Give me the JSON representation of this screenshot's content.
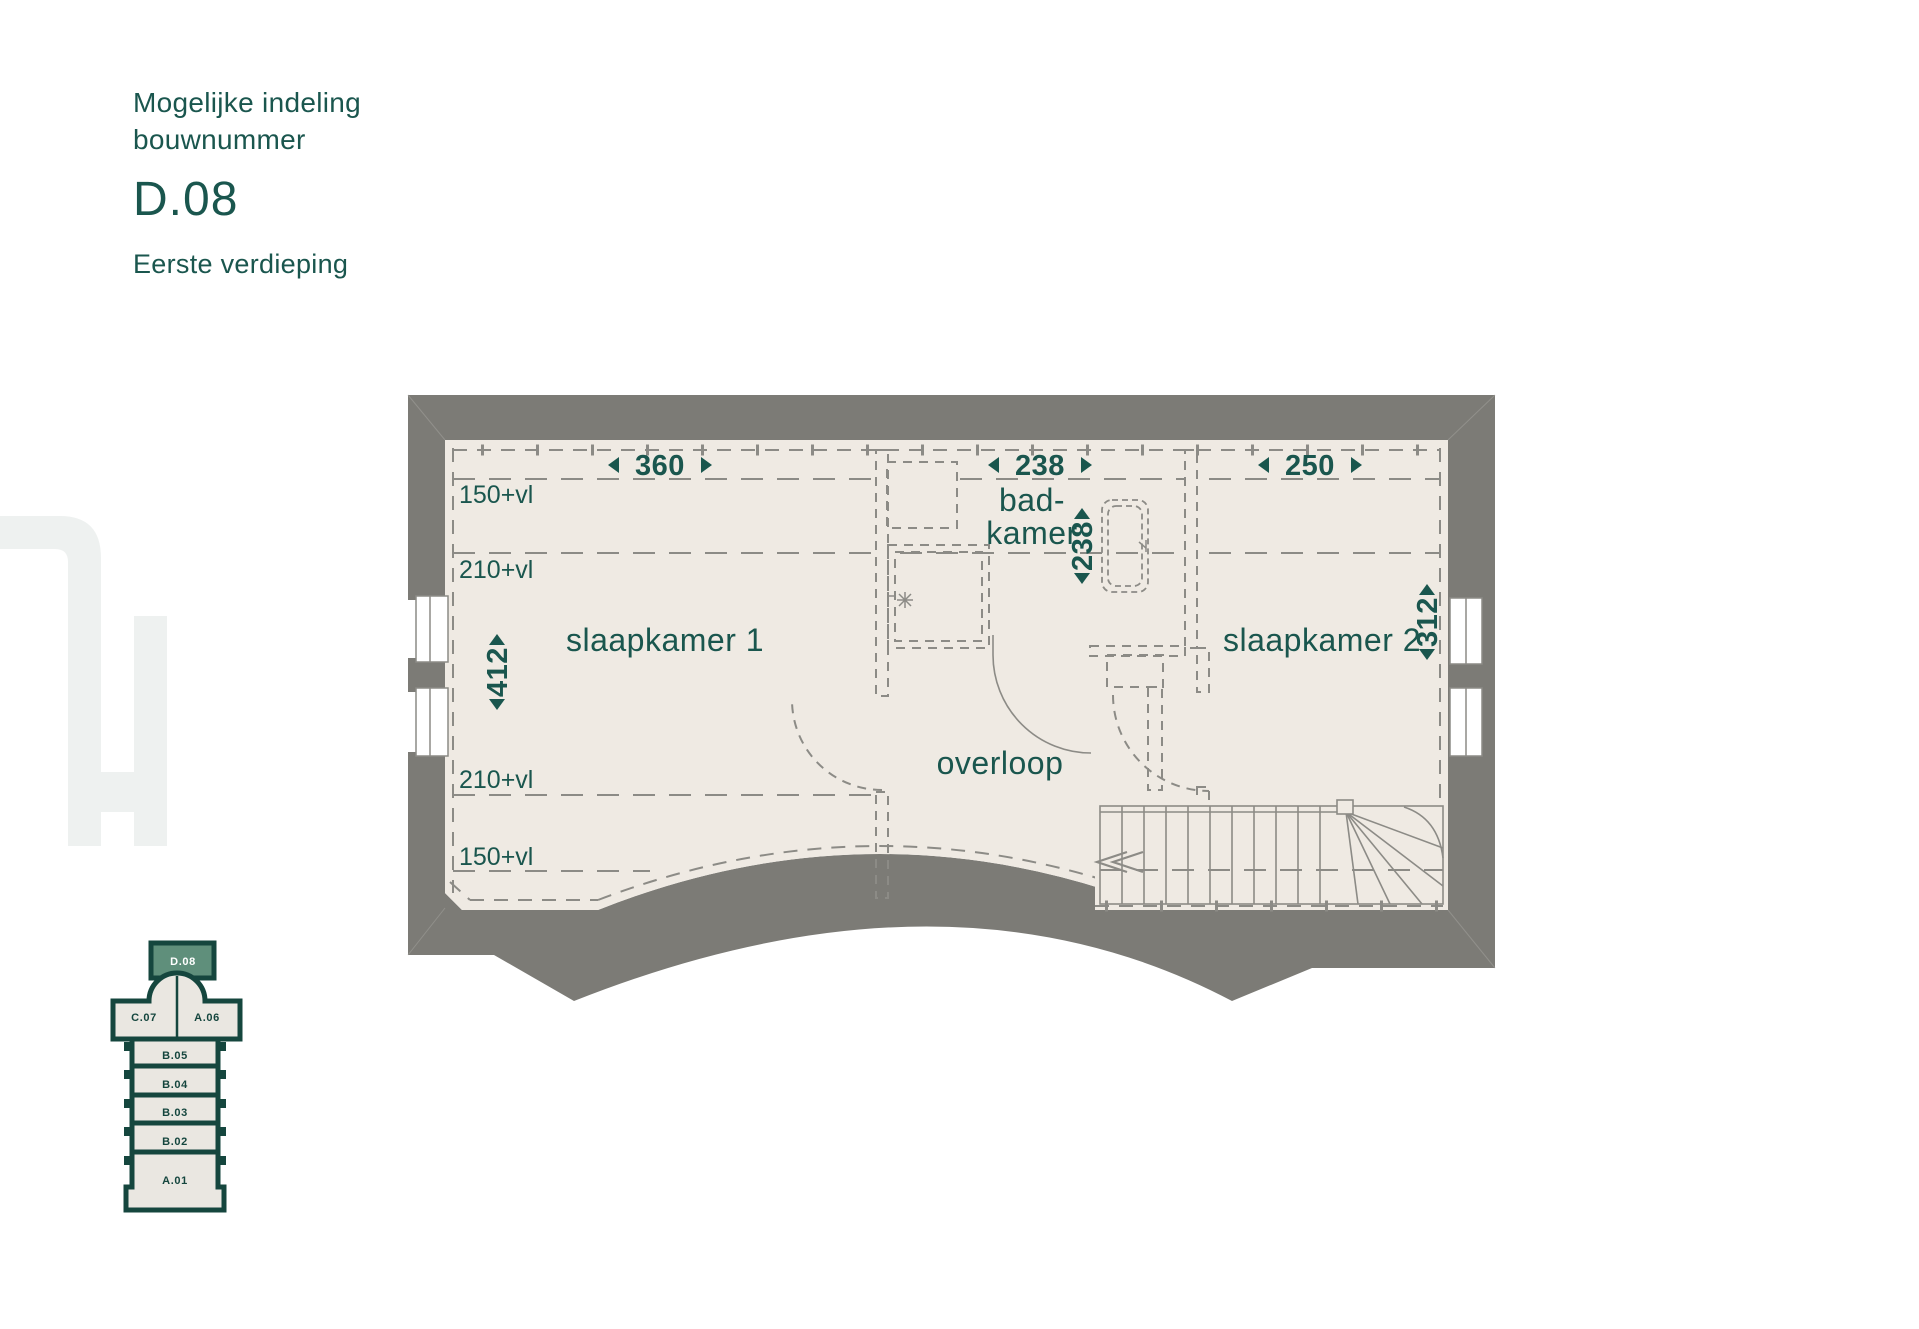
{
  "header": {
    "line1": "Mogelijke indeling",
    "line2": "bouwnummer",
    "unit": "D.08",
    "floor": "Eerste verdieping"
  },
  "floorplan": {
    "room_labels": {
      "bedroom1": "slaapkamer 1",
      "bedroom2": "slaapkamer 2",
      "bathroom_line1": "bad-",
      "bathroom_line2": "kamer",
      "landing": "overloop"
    },
    "dimensions": {
      "bedroom1_width": "360",
      "bathroom_width": "238",
      "bedroom2_width": "250",
      "bedroom1_depth": "412",
      "bathroom_depth": "238",
      "bedroom2_depth": "312"
    },
    "height_zones": {
      "top_outer": "150+vl",
      "top_inner": "210+vl",
      "bottom_inner": "210+vl",
      "bottom_outer": "150+vl"
    }
  },
  "site_plan": {
    "highlighted_unit": "D.08",
    "units": [
      "C.07",
      "A.06",
      "B.05",
      "B.04",
      "B.03",
      "B.02",
      "A.01"
    ]
  },
  "colors": {
    "accent_teal": "#1a564e",
    "wall_gray": "#7c7b76",
    "floor_cream": "#efeae3",
    "dash_gray": "#8c8b86",
    "site_outline": "#15463e",
    "site_fill": "#eae7e1",
    "highlight_green": "#5f8f7b",
    "watermark": "#eef1f0"
  }
}
